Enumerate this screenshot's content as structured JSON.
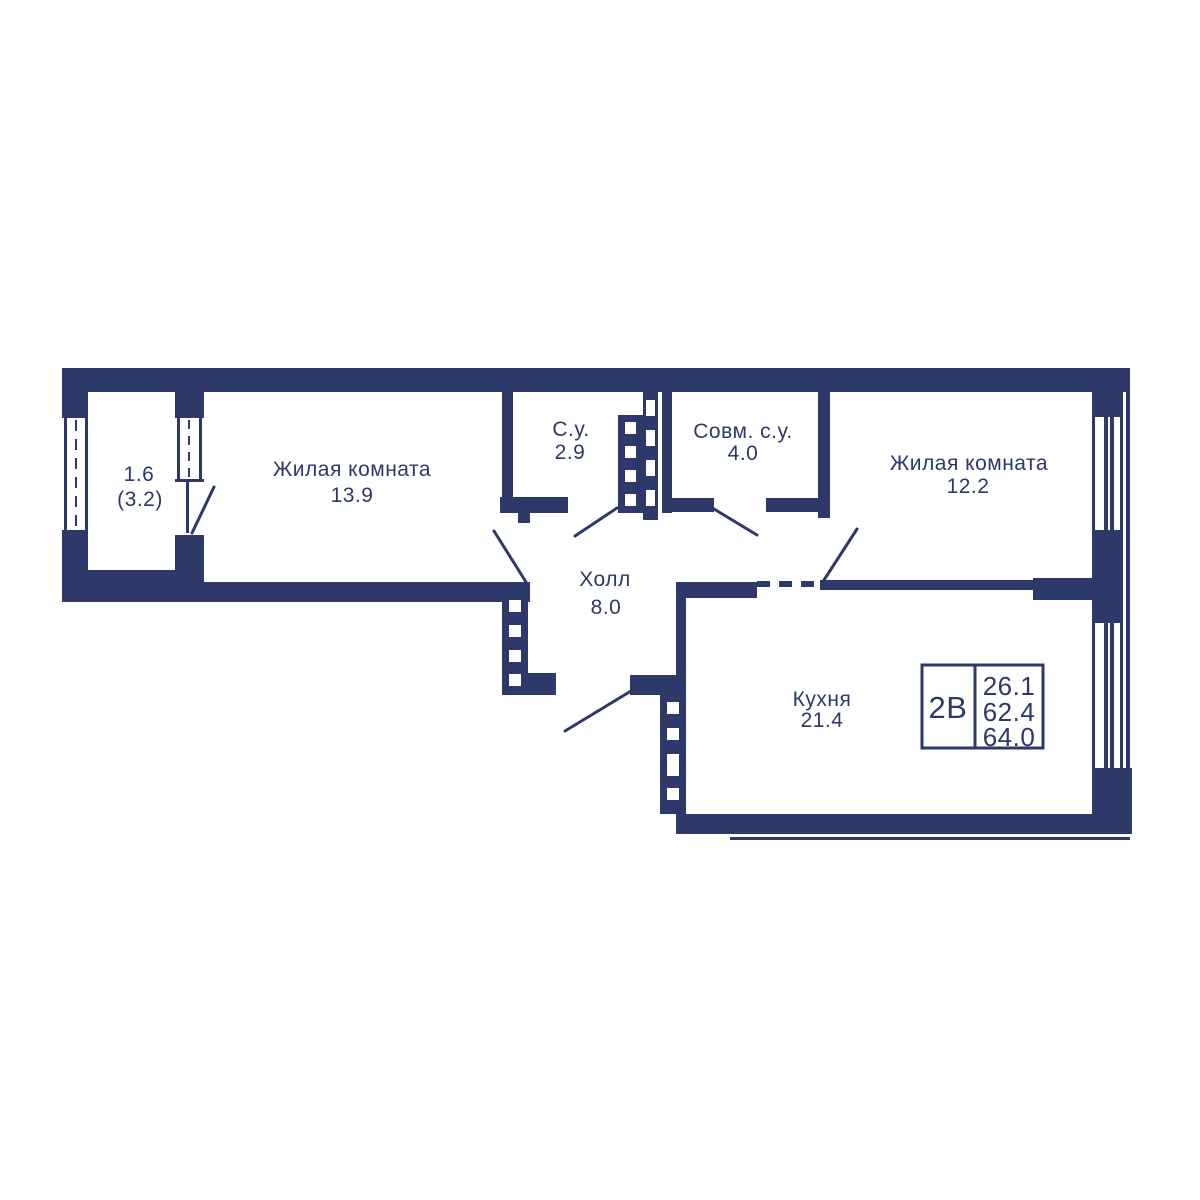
{
  "colors": {
    "wall": "#2d3968",
    "background": "#ffffff"
  },
  "rooms": {
    "balcony": {
      "area": "1.6",
      "area_total": "(3.2)"
    },
    "living1": {
      "label": "Жилая комната",
      "area": "13.9"
    },
    "bathroom": {
      "label": "С.у.",
      "area": "2.9"
    },
    "bathroom_combined": {
      "label": "Совм. с.у.",
      "area": "4.0"
    },
    "living2": {
      "label": "Жилая комната",
      "area": "12.2"
    },
    "hall": {
      "label": "Холл",
      "area": "8.0"
    },
    "kitchen": {
      "label": "Кухня",
      "area": "21.4"
    }
  },
  "info_box": {
    "type": "2В",
    "living_area": "26.1",
    "area_without_balcony": "62.4",
    "total_area": "64.0"
  }
}
